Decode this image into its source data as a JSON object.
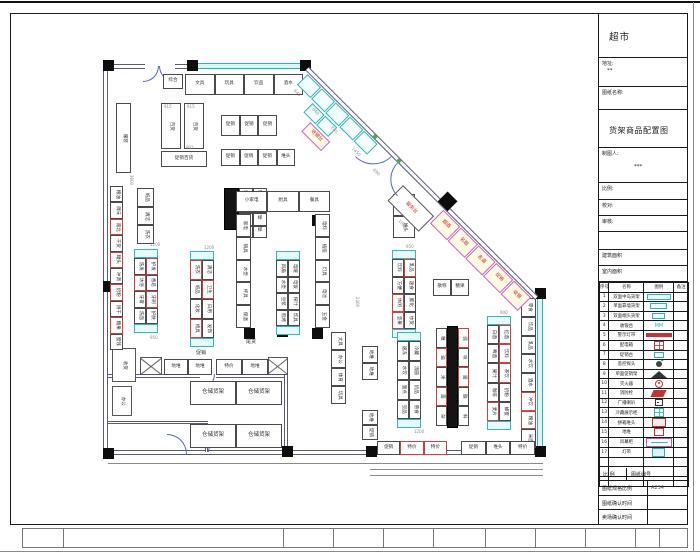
{
  "title_block": {
    "store_name": "超市",
    "address_label": "地址:",
    "address_value": "**",
    "drawing_name_label": "图纸名称:",
    "drawing_name": "货架商品配置图",
    "drafter_label": "制图人:",
    "drafter_value": "***",
    "scale_label": "比例:",
    "check_label": "校对:",
    "audit_label": "审核:",
    "building_area_label": "建筑面积",
    "indoor_area_label": "室内面积",
    "legend_headers": [
      "序号",
      "名称",
      "图例",
      "备注"
    ],
    "legend_rows": [
      {
        "no": "1",
        "name": "双面中岛货架",
        "icon": "teal-rect"
      },
      {
        "no": "2",
        "name": "单面靠墙货架",
        "icon": "teal-rect-sm"
      },
      {
        "no": "3",
        "name": "双面端头货架",
        "icon": "teal-rect-xs"
      },
      {
        "no": "4",
        "name": "收银台",
        "icon": "mm",
        "glyph": "MM"
      },
      {
        "no": "5",
        "name": "警示灯带",
        "icon": "red-bar"
      },
      {
        "no": "6",
        "name": "配电箱",
        "icon": "red-grid"
      },
      {
        "no": "7",
        "name": "促销台",
        "icon": "teal-sm"
      },
      {
        "no": "8",
        "name": "监控探头",
        "icon": "cam"
      },
      {
        "no": "9",
        "name": "单面促销架",
        "icon": "fan"
      },
      {
        "no": "10",
        "name": "灭火器",
        "icon": "red-circle"
      },
      {
        "no": "11",
        "name": "消防栓",
        "icon": "red-flag"
      },
      {
        "no": "12",
        "name": "广播喇叭",
        "icon": "speaker"
      },
      {
        "no": "13",
        "name": "冷藏展示柜",
        "icon": "teal-grid"
      },
      {
        "no": "14",
        "name": "拼箱堆头",
        "icon": "red-box"
      },
      {
        "no": "15",
        "name": "地堆",
        "icon": "red-box-sm"
      },
      {
        "no": "16",
        "name": "风幕柜",
        "icon": "purple-box"
      },
      {
        "no": "17",
        "name": "灯带",
        "icon": "teal-box"
      }
    ],
    "footer": {
      "scale_header": "比 例",
      "number_header": "图纸编号",
      "spec_label": "图纸规格比例",
      "spec_value": "A234",
      "confirm1": "图纸确认时间",
      "confirm2": "卖场确认时间"
    }
  },
  "plan": {
    "columns": [
      [
        103,
        60
      ],
      [
        187,
        60
      ],
      [
        300,
        60
      ],
      [
        103,
        281
      ],
      [
        103,
        448
      ],
      [
        277,
        326
      ],
      [
        244,
        215
      ],
      [
        312,
        215
      ],
      [
        244,
        328
      ],
      [
        312,
        328
      ],
      [
        535,
        288
      ],
      [
        535,
        446
      ],
      [
        366,
        446
      ],
      [
        282,
        446
      ]
    ],
    "walls": [
      {
        "x": 103,
        "y": 64,
        "w": 42,
        "h": 5,
        "d": "h"
      },
      {
        "x": 175,
        "y": 64,
        "w": 22,
        "h": 5,
        "d": "h"
      },
      {
        "x": 195,
        "y": 63,
        "w": 113,
        "h": 6,
        "d": "win"
      },
      {
        "x": 103,
        "y": 64,
        "w": 5,
        "h": 390,
        "d": "v"
      },
      {
        "x": 103,
        "y": 450,
        "w": 440,
        "h": 5,
        "d": "h"
      },
      {
        "x": 537,
        "y": 292,
        "w": 6,
        "h": 160,
        "d": "winv"
      },
      {
        "x": 108,
        "y": 374,
        "w": 92,
        "h": 4,
        "d": "h"
      },
      {
        "x": 216,
        "y": 374,
        "w": 70,
        "h": 4,
        "d": "h"
      },
      {
        "x": 284,
        "y": 374,
        "w": 4,
        "h": 78,
        "d": "v"
      },
      {
        "x": 108,
        "y": 421,
        "w": 100,
        "h": 3,
        "d": "h"
      },
      {
        "x": 205,
        "y": 424,
        "w": 3,
        "h": 28,
        "d": "v"
      }
    ],
    "lines": [
      {
        "x": 108,
        "y": 463,
        "w": 435,
        "h": 1
      },
      {
        "x": 370,
        "y": 469,
        "w": 173,
        "h": 1
      },
      {
        "x": 370,
        "y": 475,
        "w": 173,
        "h": 1
      }
    ],
    "rooms": [
      {
        "x": 112,
        "y": 348,
        "w": 24,
        "h": 34,
        "lb": "收货",
        "rot": 1
      },
      {
        "x": 112,
        "y": 386,
        "w": 20,
        "h": 30,
        "lb": "办公",
        "rot": 1
      },
      {
        "x": 140,
        "y": 357,
        "w": 22,
        "h": 18,
        "cross": 1
      },
      {
        "x": 268,
        "y": 357,
        "w": 20,
        "h": 18,
        "cross": 1
      }
    ],
    "doors": [
      {
        "x": 143,
        "y": 66,
        "r": 16,
        "q": "br"
      },
      {
        "x": 159,
        "y": 66,
        "r": 16,
        "q": "bl"
      },
      {
        "x": 200,
        "y": 374,
        "r": 15,
        "q": "br"
      },
      {
        "x": 208,
        "y": 438,
        "r": 14,
        "q": "tl"
      },
      {
        "x": 167,
        "y": 434,
        "r": 20,
        "q": "tr"
      }
    ],
    "racks": [
      {
        "x": 163,
        "y": 74,
        "w": 20,
        "h": 15,
        "cols": 1,
        "rows": 1,
        "texts": [
          "综合"
        ]
      },
      {
        "x": 185,
        "y": 74,
        "w": 118,
        "h": 21,
        "cols": 4,
        "rows": 1,
        "texts": [
          "文具",
          "玩具",
          "饮品",
          "酒水"
        ]
      },
      {
        "x": 161,
        "y": 103,
        "w": 20,
        "h": 46,
        "cols": 1,
        "rows": 1,
        "texts": [
          "百货"
        ],
        "tdir": "v",
        "dim": "915"
      },
      {
        "x": 184,
        "y": 103,
        "w": 20,
        "h": 46,
        "cols": 1,
        "rows": 1,
        "texts": [
          "百货"
        ],
        "tdir": "v",
        "dim": "915"
      },
      {
        "x": 161,
        "y": 151,
        "w": 46,
        "h": 16,
        "cols": 1,
        "rows": 1,
        "texts": [
          "促销百货"
        ]
      },
      {
        "x": 221,
        "y": 115,
        "w": 56,
        "h": 21,
        "cols": 3,
        "rows": 1,
        "texts": [
          "促销",
          "促销",
          "促销"
        ]
      },
      {
        "x": 221,
        "y": 149,
        "w": 74,
        "h": 17,
        "cols": 4,
        "rows": 1,
        "texts": [
          "促销",
          "促销",
          "促销",
          "堆头"
        ]
      },
      {
        "x": 116,
        "y": 103,
        "w": 15,
        "h": 70,
        "cols": 1,
        "rows": 1,
        "texts": [
          "服装"
        ],
        "tdir": "v"
      },
      {
        "x": 110,
        "y": 186,
        "w": 13,
        "h": 164,
        "cols": 1,
        "rows": 10,
        "red": [
          2,
          4,
          6,
          8
        ],
        "texts": [
          "粮油",
          "调味",
          "南北",
          "干货",
          "罐头",
          "冲调",
          "奶粉",
          "饼干",
          "糖果",
          "蜜饯"
        ],
        "tdir": "v"
      },
      {
        "x": 137,
        "y": 188,
        "w": 17,
        "h": 56,
        "cols": 1,
        "rows": 3,
        "texts": [
          "纸品",
          "清洁",
          "洗衣"
        ],
        "tdir": "v"
      },
      {
        "x": 224,
        "y": 188,
        "w": 15,
        "h": 42,
        "cols": 1,
        "rows": 1,
        "solid": 1
      },
      {
        "x": 239,
        "y": 188,
        "w": 28,
        "h": 50,
        "cols": 2,
        "rows": 4,
        "texts": [
          "楼",
          "梯"
        ]
      },
      {
        "x": 134,
        "y": 249,
        "w": 24,
        "h": 84,
        "cols": 2,
        "rows": 4,
        "cap": 1,
        "red": [
          1,
          2,
          5
        ],
        "texts": [
          "洗发",
          "护发",
          "沐浴",
          "香皂",
          "牙膏",
          "牙刷",
          "洗面",
          "护肤"
        ],
        "tdir": "v"
      },
      {
        "x": 190,
        "y": 251,
        "w": 24,
        "h": 96,
        "cols": 2,
        "rows": 4,
        "cap": 1,
        "red": [
          0,
          3,
          6
        ],
        "texts": [
          "洗衣",
          "清洁",
          "纸品",
          "卫生",
          "化妆",
          "日用",
          "梳具",
          "发饰"
        ],
        "tdir": "v"
      },
      {
        "x": 236,
        "y": 191,
        "w": 94,
        "h": 21,
        "cols": 3,
        "rows": 1,
        "texts": [
          "小家电",
          "厨具",
          "餐具"
        ]
      },
      {
        "x": 236,
        "y": 214,
        "w": 15,
        "h": 114,
        "cols": 1,
        "rows": 5,
        "texts": [
          "家电",
          "锅具",
          "水壶",
          "杯具",
          "保温"
        ],
        "tdir": "v"
      },
      {
        "x": 315,
        "y": 214,
        "w": 15,
        "h": 114,
        "cols": 1,
        "rows": 5,
        "texts": [
          "电料",
          "插座",
          "灯具",
          "电池",
          "五金"
        ],
        "tdir": "v"
      },
      {
        "x": 276,
        "y": 251,
        "w": 24,
        "h": 84,
        "cols": 2,
        "rows": 4,
        "cap": 1,
        "texts": [
          "风扇",
          "电暖",
          "水壶",
          "电饭",
          "豆浆",
          "榨汁",
          "煎烤",
          "炊具"
        ],
        "tdir": "v"
      },
      {
        "x": 393,
        "y": 194,
        "w": 22,
        "h": 44,
        "cols": 1,
        "rows": 2,
        "texts": [
          "大促",
          "堆头"
        ],
        "tdir": "v"
      },
      {
        "x": 392,
        "y": 250,
        "w": 24,
        "h": 88,
        "cols": 2,
        "rows": 4,
        "cap": 1,
        "red": [
          1,
          4,
          6
        ],
        "texts": [
          "饮料",
          "乳品",
          "方便",
          "速食",
          "休闲",
          "膨化",
          "坚果",
          "炒货"
        ],
        "tdir": "v"
      },
      {
        "x": 433,
        "y": 279,
        "w": 36,
        "h": 17,
        "cols": 2,
        "rows": 1,
        "texts": [
          "散称",
          "糖果"
        ]
      },
      {
        "x": 521,
        "y": 298,
        "w": 15,
        "h": 150,
        "cols": 1,
        "rows": 8,
        "red": [
          5,
          6
        ],
        "texts": [
          "零食",
          "饮品",
          "乳品",
          "水饮",
          "酒水",
          "冲饮",
          "粮油",
          "米面"
        ],
        "tdir": "v"
      },
      {
        "x": 487,
        "y": 316,
        "w": 24,
        "h": 114,
        "cols": 2,
        "rows": 5,
        "cap": 1,
        "red": [
          1,
          3,
          5,
          8
        ],
        "texts": [
          "白酒",
          "红酒",
          "啤酒",
          "饮料",
          "果汁",
          "茶饮",
          "咖啡",
          "奶粉",
          "麦片",
          "蜂蜜"
        ],
        "tdir": "v"
      },
      {
        "x": 447,
        "y": 326,
        "w": 11,
        "h": 102,
        "cols": 1,
        "rows": 1,
        "solid": 1
      },
      {
        "x": 436,
        "y": 328,
        "w": 11,
        "h": 98,
        "cols": 1,
        "rows": 5,
        "red": [
          1,
          3
        ],
        "texts": [
          "粮",
          "油",
          "米",
          "面",
          "杂"
        ],
        "tdir": "v"
      },
      {
        "x": 458,
        "y": 328,
        "w": 11,
        "h": 98,
        "cols": 1,
        "rows": 5,
        "red": [
          0,
          2
        ],
        "texts": [
          "调",
          "味",
          "酱",
          "醋",
          "料"
        ],
        "tdir": "v"
      },
      {
        "x": 397,
        "y": 332,
        "w": 24,
        "h": 96,
        "cols": 2,
        "rows": 4,
        "cap": 1,
        "texts": [
          "速冻",
          "冷藏",
          "水饺",
          "汤圆",
          "面点",
          "奶品",
          "豆品",
          "熟食"
        ],
        "tdir": "v"
      },
      {
        "x": 331,
        "y": 332,
        "w": 15,
        "h": 72,
        "cols": 1,
        "rows": 4,
        "texts": [
          "文具",
          "办公",
          "体育",
          "玩具"
        ],
        "tdir": "v"
      },
      {
        "x": 362,
        "y": 346,
        "w": 16,
        "h": 34,
        "cols": 1,
        "rows": 2,
        "texts": [
          "地堆",
          "地堆"
        ],
        "tdir": "v"
      },
      {
        "x": 362,
        "y": 410,
        "w": 16,
        "h": 30,
        "cols": 1,
        "rows": 2,
        "texts": [
          "地堆",
          "促销"
        ],
        "tdir": "v"
      },
      {
        "x": 164,
        "y": 359,
        "w": 48,
        "h": 16,
        "cols": 2,
        "rows": 1,
        "texts": [
          "地堆",
          "地堆"
        ]
      },
      {
        "x": 216,
        "y": 359,
        "w": 52,
        "h": 16,
        "cols": 2,
        "rows": 1,
        "texts": [
          "特价",
          "地堆"
        ]
      },
      {
        "x": 190,
        "y": 381,
        "w": 92,
        "h": 24,
        "cols": 2,
        "rows": 1,
        "texts": [
          "仓储货架",
          "仓储货架"
        ],
        "fs": 5.5
      },
      {
        "x": 190,
        "y": 424,
        "w": 92,
        "h": 24,
        "cols": 2,
        "rows": 1,
        "texts": [
          "仓储货架",
          "仓储货架"
        ],
        "fs": 5.5
      },
      {
        "x": 377,
        "y": 441,
        "w": 70,
        "h": 14,
        "cols": 3,
        "rows": 1,
        "red": [
          1,
          2
        ],
        "texts": [
          "促销",
          "特价",
          "特价"
        ]
      },
      {
        "x": 461,
        "y": 441,
        "w": 74,
        "h": 14,
        "cols": 3,
        "rows": 1,
        "texts": [
          "促销",
          "堆头",
          "特价"
        ]
      }
    ],
    "diag": {
      "x": 309,
      "y": 67,
      "len": 324,
      "cells": [
        {
          "t": 4,
          "o": 1,
          "w": 19,
          "h": 15,
          "s": "c"
        },
        {
          "t": 24,
          "o": 1,
          "w": 19,
          "h": 15,
          "s": "c"
        },
        {
          "t": 44,
          "o": 1,
          "w": 19,
          "h": 15,
          "s": "c"
        },
        {
          "t": 64,
          "o": 1,
          "w": 19,
          "h": 15,
          "s": "c"
        },
        {
          "t": 84,
          "o": 1,
          "w": 19,
          "h": 15,
          "s": "c"
        },
        {
          "t": 28,
          "o": 18,
          "w": 17,
          "h": 13,
          "s": "c"
        },
        {
          "t": 46,
          "o": 18,
          "w": 17,
          "h": 13,
          "s": "c"
        },
        {
          "t": 40,
          "o": 33,
          "w": 28,
          "h": 13,
          "s": "p",
          "lb": "收银台"
        },
        {
          "t": 150,
          "o": 12,
          "w": 44,
          "h": 22,
          "s": "w",
          "lb": "服务台"
        },
        {
          "t": 196,
          "o": 1,
          "w": 24,
          "h": 19,
          "s": "p",
          "lb": "烟酒"
        },
        {
          "t": 221,
          "o": 1,
          "w": 24,
          "h": 19,
          "s": "p",
          "lb": "名烟"
        },
        {
          "t": 246,
          "o": 1,
          "w": 24,
          "h": 19,
          "s": "p",
          "lb": "名酒"
        },
        {
          "t": 271,
          "o": 1,
          "w": 24,
          "h": 19,
          "s": "p",
          "lb": "促销"
        },
        {
          "t": 296,
          "o": 1,
          "w": 24,
          "h": 19,
          "s": "p",
          "lb": "收银"
        }
      ],
      "dims": [
        {
          "t": 6,
          "o": 20,
          "v": "640"
        },
        {
          "t": 32,
          "o": 20,
          "v": "640"
        },
        {
          "t": 58,
          "o": 20,
          "v": "740"
        },
        {
          "t": 88,
          "o": 20,
          "v": "1450"
        },
        {
          "t": 118,
          "o": 20,
          "v": "690"
        },
        {
          "t": 172,
          "o": 38,
          "v": "1060"
        }
      ],
      "arcs": [
        {
          "t": 96,
          "r": 26,
          "q": "br"
        },
        {
          "t": 130,
          "r": 24,
          "q": "bl"
        }
      ],
      "greens": [
        94,
        128
      ],
      "diamond": {
        "t": 186,
        "size": 14
      }
    },
    "labels": [
      {
        "x": 186,
        "y": 146,
        "t": "902",
        "c": "dim",
        "fs": 4
      },
      {
        "x": 150,
        "y": 243,
        "t": "1200",
        "c": "dim",
        "fs": 4
      },
      {
        "x": 204,
        "y": 246,
        "t": "1200",
        "c": "dim",
        "fs": 4
      },
      {
        "x": 406,
        "y": 245,
        "t": "950",
        "c": "dim",
        "fs": 4
      },
      {
        "x": 500,
        "y": 311,
        "t": "900",
        "c": "dim",
        "fs": 4
      },
      {
        "x": 150,
        "y": 336,
        "t": "950",
        "c": "dim",
        "fs": 4
      },
      {
        "x": 414,
        "y": 430,
        "t": "1200",
        "c": "dim",
        "fs": 4
      },
      {
        "x": 352,
        "y": 300,
        "t": "2400",
        "c": "dim",
        "fs": 4,
        "rot": 90
      },
      {
        "x": 126,
        "y": 178,
        "t": "3600",
        "c": "dim",
        "fs": 4,
        "rot": 90
      },
      {
        "x": 246,
        "y": 340,
        "t": "尾货",
        "c": "k",
        "fs": 5
      },
      {
        "x": 196,
        "y": 351,
        "t": "促销",
        "c": "k",
        "fs": 5
      }
    ]
  }
}
